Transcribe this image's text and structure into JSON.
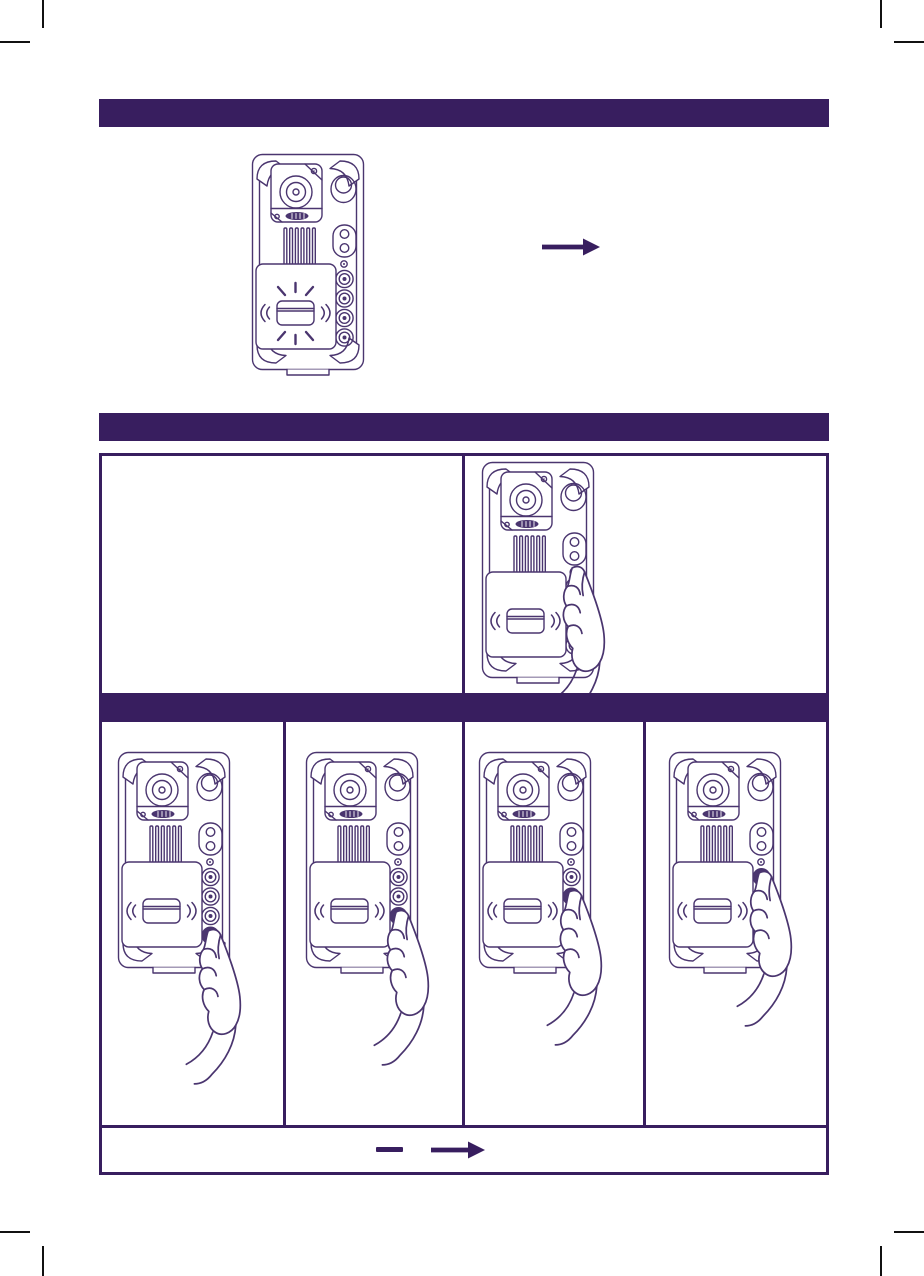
{
  "page": {
    "background": "#ffffff"
  },
  "colors": {
    "accent": "#381e5f",
    "line_art": "#4a356f",
    "table_border": "#381e5f",
    "crop_mark": "#111111"
  },
  "sections": {
    "top_banner": {
      "label": ""
    },
    "middle_banner": {
      "label": ""
    },
    "inner_banner": {
      "label": ""
    }
  },
  "intro_figure": {
    "device_icon": "video-intercom-device-icon",
    "card_reader_state": "flashing",
    "arrow_icon": "arrow-right-icon"
  },
  "instruction_table": {
    "row1": {
      "left_cell_text": "",
      "right_cell": {
        "device_icon": "video-intercom-device-icon",
        "hand_icon": "pointing-hand-icon",
        "pressed_control": "programming-button"
      }
    },
    "steps": [
      {
        "device_icon": "video-intercom-device-icon",
        "hand_icon": "pointing-hand-icon",
        "pressed_call_button": 4
      },
      {
        "device_icon": "video-intercom-device-icon",
        "hand_icon": "pointing-hand-icon",
        "pressed_call_button": 3
      },
      {
        "device_icon": "video-intercom-device-icon",
        "hand_icon": "pointing-hand-icon",
        "pressed_call_button": 2
      },
      {
        "device_icon": "video-intercom-device-icon",
        "hand_icon": "pointing-hand-icon",
        "pressed_call_button": 1
      }
    ],
    "footer": {
      "minus_icon": "minus-icon",
      "arrow_icon": "arrow-right-icon"
    }
  }
}
